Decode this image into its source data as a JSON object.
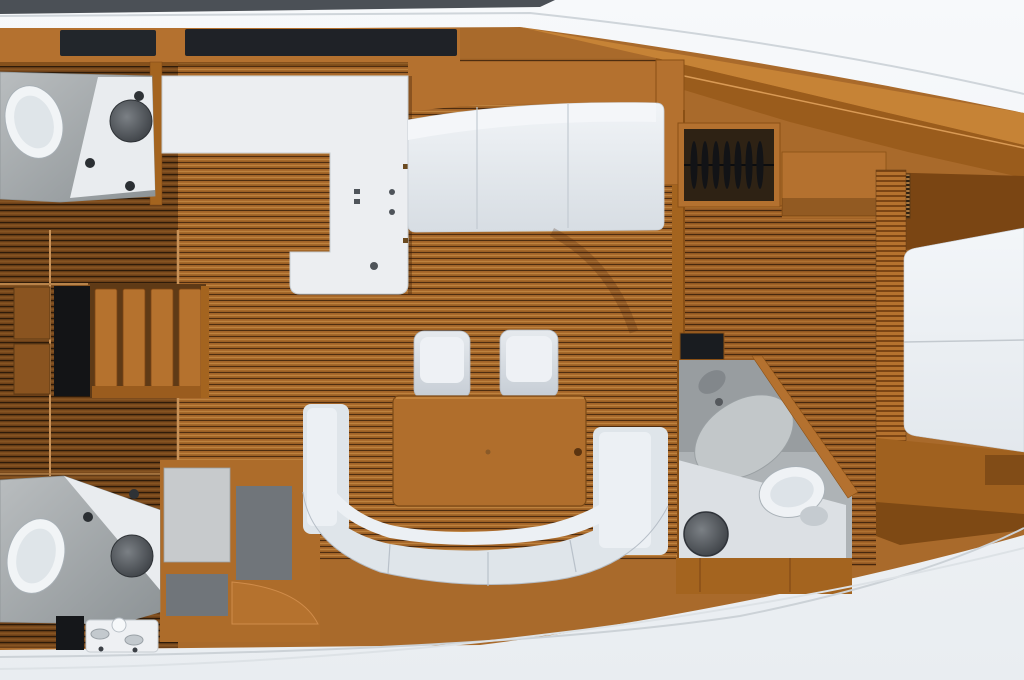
{
  "canvas": {
    "width": 1024,
    "height": 680,
    "type": "yacht-interior-floor-plan",
    "view": "top-down"
  },
  "palette": {
    "hull_white": "#f3f6f9",
    "hull_line": "#ccd2d8",
    "deck_stripe_dark": "#4b5056",
    "wood_cabinet": "#a96a2b",
    "wood_ceiling_band": "#c68336",
    "wood_wall_dark": "#9a5c1c",
    "wood_shadow": "#7a4513",
    "wood_trim_light": "#d99a55",
    "table_wood": "#b06e2c",
    "counter_white": "#eceef1",
    "upholstery_white": "#dfe5ea",
    "upholstery_highlight": "#ecf0f4",
    "platform_gray": "#a7abae",
    "room_gray": "#aeb3b6",
    "panel_gray_light": "#c7cacc",
    "panel_gray_dark": "#70757a",
    "fixture_dark": "#3e4247",
    "hatch_dark": "#22262b",
    "recess_black": "#131416",
    "stair_tread": "#b5722e"
  },
  "fixtures": [
    "toilet",
    "washbasin",
    "faucet",
    "shower-pan",
    "stove-burners",
    "dining-table",
    "stool",
    "settee",
    "v-berth-bed",
    "clothes-hangers",
    "companionway-steps",
    "deck-hatch",
    "locker",
    "vent-grille",
    "drain"
  ],
  "zones": [
    "aft-head-port",
    "aft-head-starboard",
    "aft-cabin-access",
    "galley",
    "salon",
    "forward-cabin",
    "forward-head",
    "v-berth"
  ]
}
